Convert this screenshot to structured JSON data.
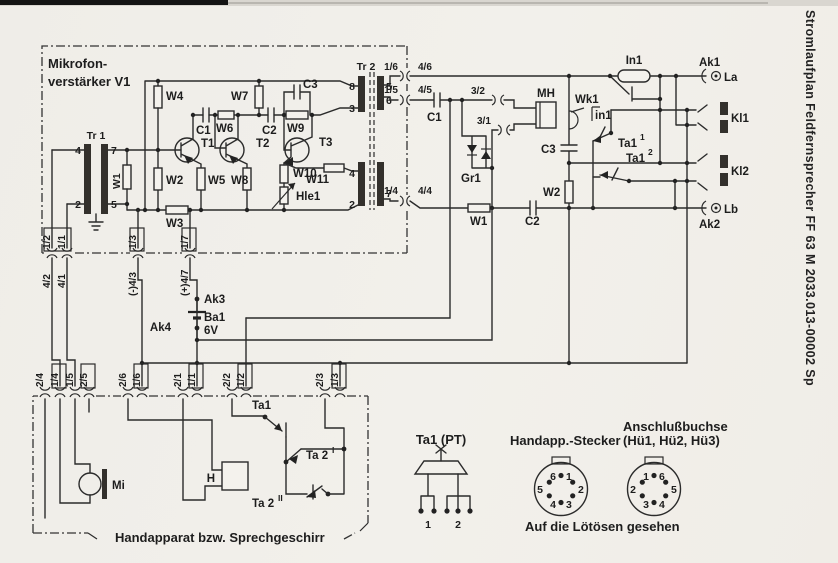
{
  "side_title": "Stromlaufplan Feldfernsprecher FF 63 M 2033.013-00002 Sp",
  "module": {
    "line1": "Mikrofon-",
    "line2": "verstärker V1"
  },
  "tr1": {
    "name": "Tr 1",
    "t4": "4",
    "t7": "7",
    "t2": "2",
    "t5": "5",
    "w1": "W1"
  },
  "amp": {
    "w2": "W2",
    "w3": "W3",
    "w4": "W4",
    "w5": "W5",
    "w6": "W6",
    "w7": "W7",
    "w8": "W8",
    "w9": "W9",
    "w10": "W10",
    "w11": "W11",
    "c1": "C1",
    "c2": "C2",
    "c3": "C3",
    "t1": "T1",
    "t2": "T2",
    "t3": "T3",
    "hle1": "Hle1"
  },
  "tr2": {
    "name": "Tr 2",
    "t8": "8",
    "t3": "3",
    "t4": "4",
    "t2": "2",
    "t5": "5",
    "t6": "6",
    "t7": "7"
  },
  "edge_right": [
    {
      "a": "1/6",
      "b": "4/6"
    },
    {
      "a": "1/5",
      "b": "4/5"
    },
    {
      "a": "1/4",
      "b": "4/4"
    }
  ],
  "edge_bottom": [
    {
      "a": "1/2",
      "b": "4/2"
    },
    {
      "a": "1/1",
      "b": "4/1"
    },
    {
      "a": "1/3",
      "b": "(-)4/3"
    },
    {
      "a": "1/7",
      "b": "(+)4/7"
    }
  ],
  "mid": {
    "c1": "C1",
    "p32": "3/2",
    "p31": "3/1",
    "gr1": "Gr1",
    "w1": "W1",
    "c2": "C2",
    "mh": "MH",
    "wk1": "Wk1",
    "in1_switch": "in1",
    "c3": "C3",
    "w2": "W2"
  },
  "ring": {
    "in1_lamp": "In1",
    "ak1": "Ak1",
    "la": "La",
    "kl1": "Kl1",
    "kl2": "Kl2",
    "lb": "Lb",
    "ak2": "Ak2",
    "ta1c1": "Ta1",
    "ta1c1s": "1",
    "ta1c2": "Ta1",
    "ta1c2s": "2"
  },
  "battery": {
    "ak3": "Ak3",
    "ak4": "Ak4",
    "ba1": "Ba1",
    "volt": "6V"
  },
  "row_bottom": [
    {
      "a": "2/4",
      "b": "1/4"
    },
    {
      "a": "1/5",
      "b": "2/5"
    },
    {
      "a": "2/6",
      "b": "1/6"
    },
    {
      "a": "2/1",
      "b": "1/1"
    },
    {
      "a": "2/2",
      "b": "1/2"
    },
    {
      "a": "2/3",
      "b": "1/3"
    }
  ],
  "handset": {
    "mi": "Mi",
    "h": "H",
    "ta1": "Ta1",
    "ta2a": "Ta 2",
    "ta2as": "I",
    "ta2b": "Ta 2",
    "ta2bs": "II",
    "caption": "Handapparat bzw. Sprechgeschirr"
  },
  "figures": {
    "pt_title": "Ta1 (PT)",
    "pin1": "1",
    "pin2": "2",
    "plug_title": "Handapp.-Stecker",
    "socket_title1": "Anschlußbuchse",
    "socket_title2": "(Hü1, Hü2, Hü3)",
    "caption": "Auf die Lötösen gesehen",
    "plug_pins": [
      "6",
      "1",
      "2",
      "3",
      "4",
      "5"
    ],
    "socket_pins": [
      "1",
      "6",
      "5",
      "4",
      "3",
      "2"
    ]
  }
}
